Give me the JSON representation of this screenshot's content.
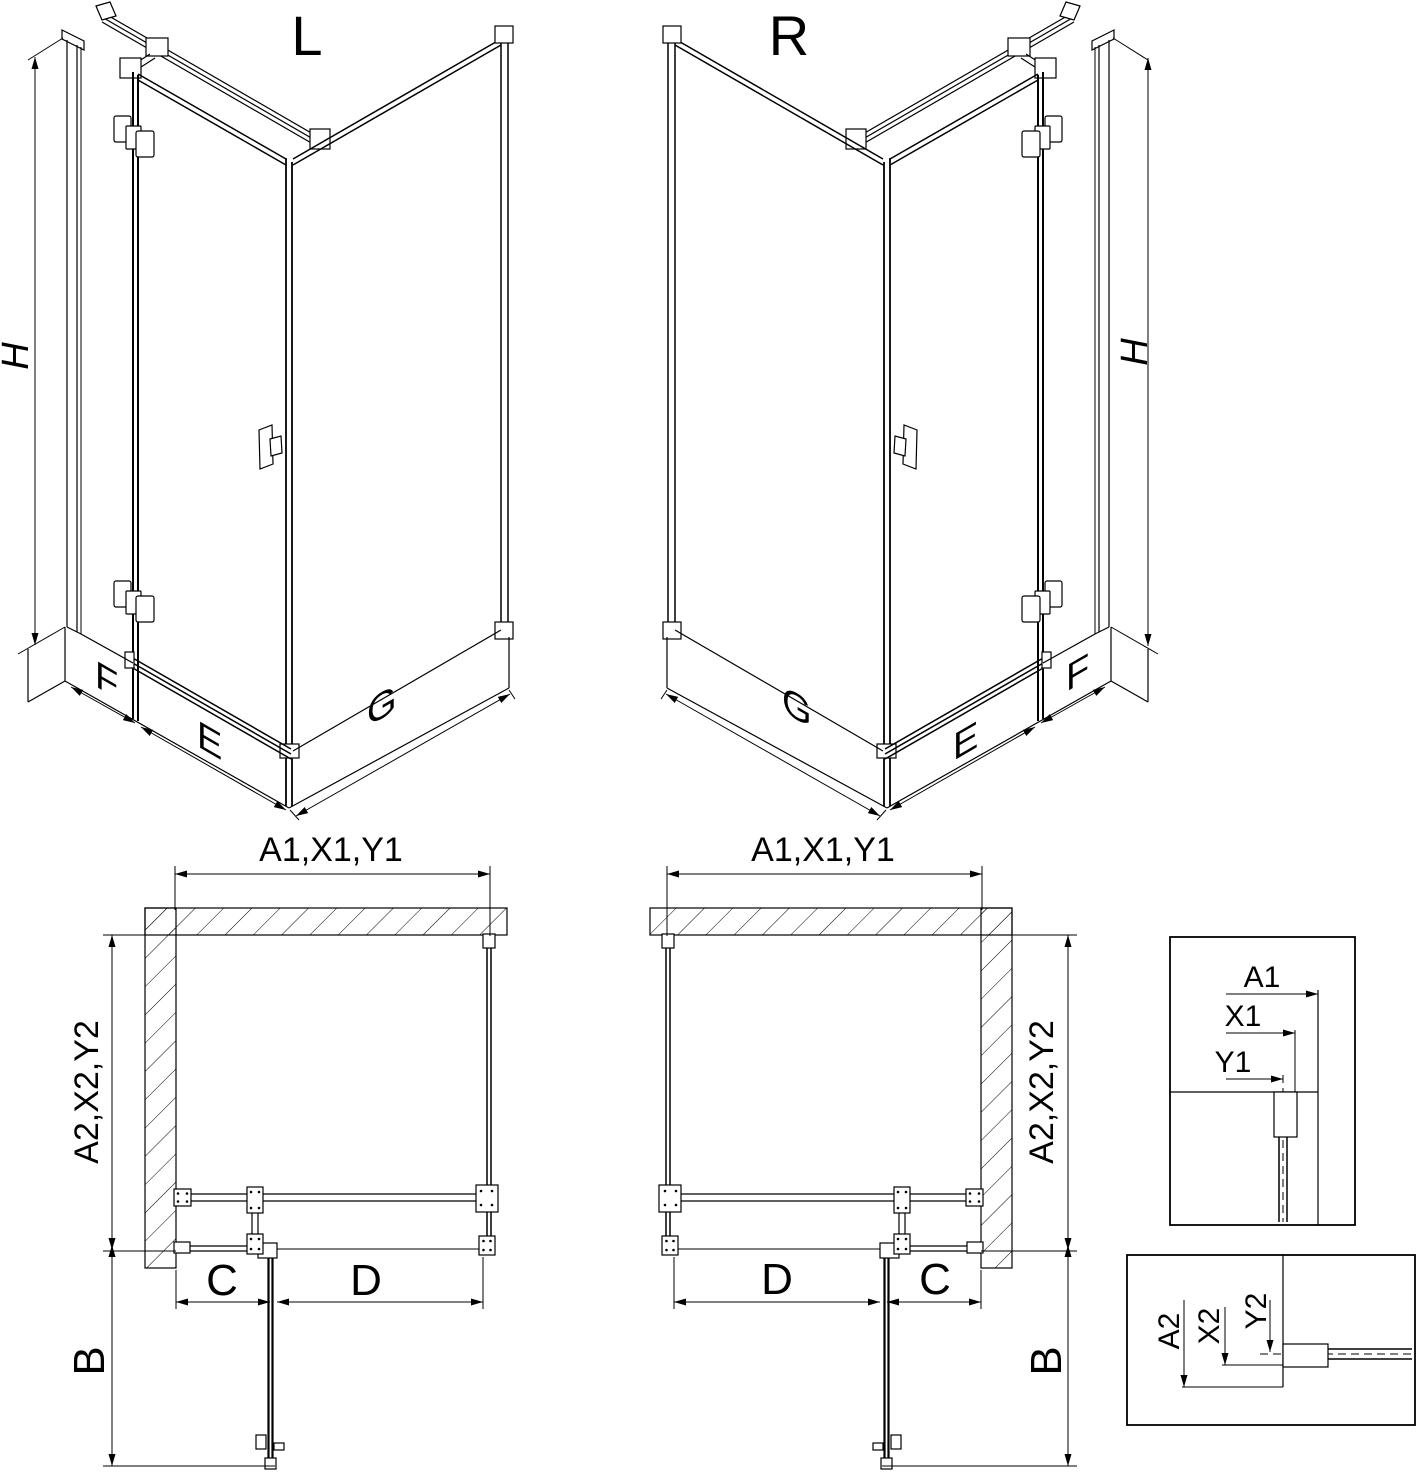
{
  "drawing": {
    "background": "#ffffff",
    "line_color": "#000000",
    "views": {
      "iso_left": {
        "label": "L",
        "height_dim": "H",
        "side_panel_dim": "F",
        "door_dim": "E",
        "return_panel_dim": "G"
      },
      "iso_right": {
        "label": "R",
        "height_dim": "H",
        "side_panel_dim": "F",
        "door_dim": "E",
        "return_panel_dim": "G"
      },
      "plan_left": {
        "width_dim": "A1,X1,Y1",
        "depth_dim": "A2,X2,Y2",
        "fixed_segment_dim": "C",
        "door_segment_dim": "D",
        "door_swing_dim": "B"
      },
      "plan_right": {
        "width_dim": "A1,X1,Y1",
        "depth_dim": "A2,X2,Y2",
        "fixed_segment_dim": "C",
        "door_segment_dim": "D",
        "door_swing_dim": "B"
      },
      "detail_width": {
        "dims": [
          "A1",
          "X1",
          "Y1"
        ]
      },
      "detail_depth": {
        "dims": [
          "A2",
          "X2",
          "Y2"
        ]
      }
    }
  }
}
